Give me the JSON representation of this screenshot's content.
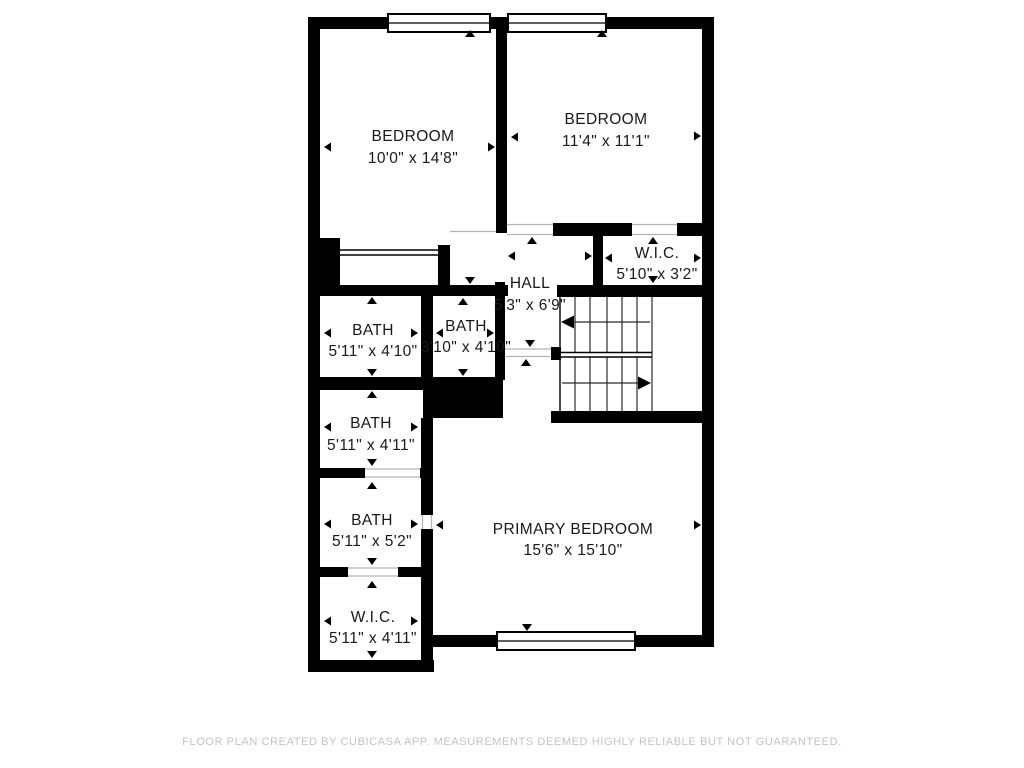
{
  "footer": {
    "text": "FLOOR PLAN CREATED BY CUBICASA APP. MEASUREMENTS DEEMED HIGHLY RELIABLE BUT NOT GUARANTEED."
  },
  "plan": {
    "colors": {
      "wall": "#000000",
      "floor": "#ffffff",
      "label": "#191919",
      "footer_text": "#c3c3c3",
      "threshold": "#b5b5b5"
    },
    "rooms": [
      {
        "id": "bedroom-1",
        "name": "BEDROOM",
        "dims": "10'0\" x 14'8\""
      },
      {
        "id": "bedroom-2",
        "name": "BEDROOM",
        "dims": "11'4\" x 11'1\""
      },
      {
        "id": "wic-top",
        "name": "W.I.C.",
        "dims": "5'10\" x 3'2\""
      },
      {
        "id": "hall",
        "name": "HALL",
        "dims": "5'3\" x 6'9\""
      },
      {
        "id": "bath-1",
        "name": "BATH",
        "dims": "5'11\" x 4'10\""
      },
      {
        "id": "bath-mid",
        "name": "BATH",
        "dims": "3'10\" x 4'10\""
      },
      {
        "id": "bath-2",
        "name": "BATH",
        "dims": "5'11\" x 4'11\""
      },
      {
        "id": "bath-3",
        "name": "BATH",
        "dims": "5'11\" x 5'2\""
      },
      {
        "id": "wic-bottom",
        "name": "W.I.C.",
        "dims": "5'11\" x 4'11\""
      },
      {
        "id": "primary-bedroom",
        "name": "PRIMARY BEDROOM",
        "dims": "15'6\" x 15'10\""
      }
    ]
  }
}
